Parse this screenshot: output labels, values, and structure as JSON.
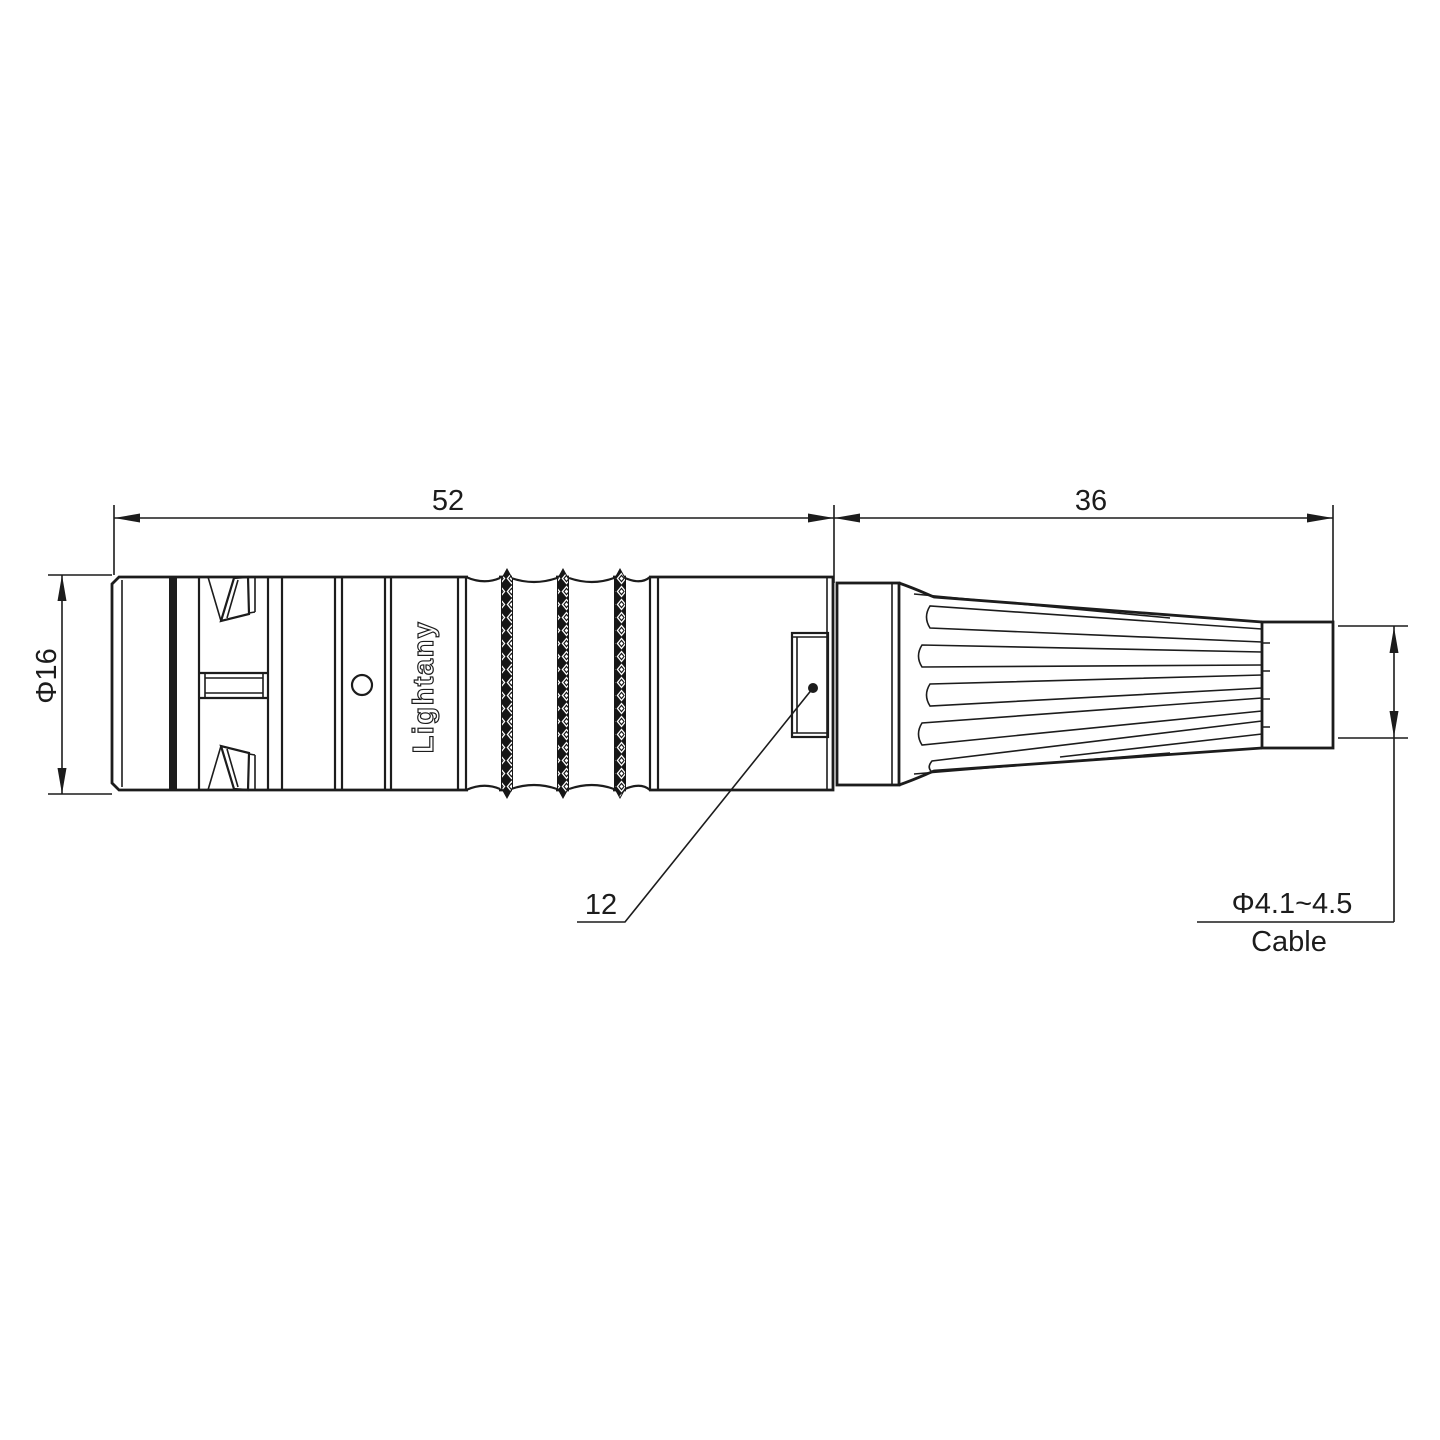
{
  "watermark": "Lightany",
  "connector": {
    "engraving": "Lightany"
  },
  "dimensions": {
    "body_length": "52",
    "boot_length": "36",
    "body_diameter": "Φ16",
    "window_size": "12",
    "cable_diameter": "Φ4.1~4.5",
    "cable_caption": "Cable"
  },
  "colors": {
    "line": "#1c1c1c",
    "watermark": "#f2bcbc"
  }
}
